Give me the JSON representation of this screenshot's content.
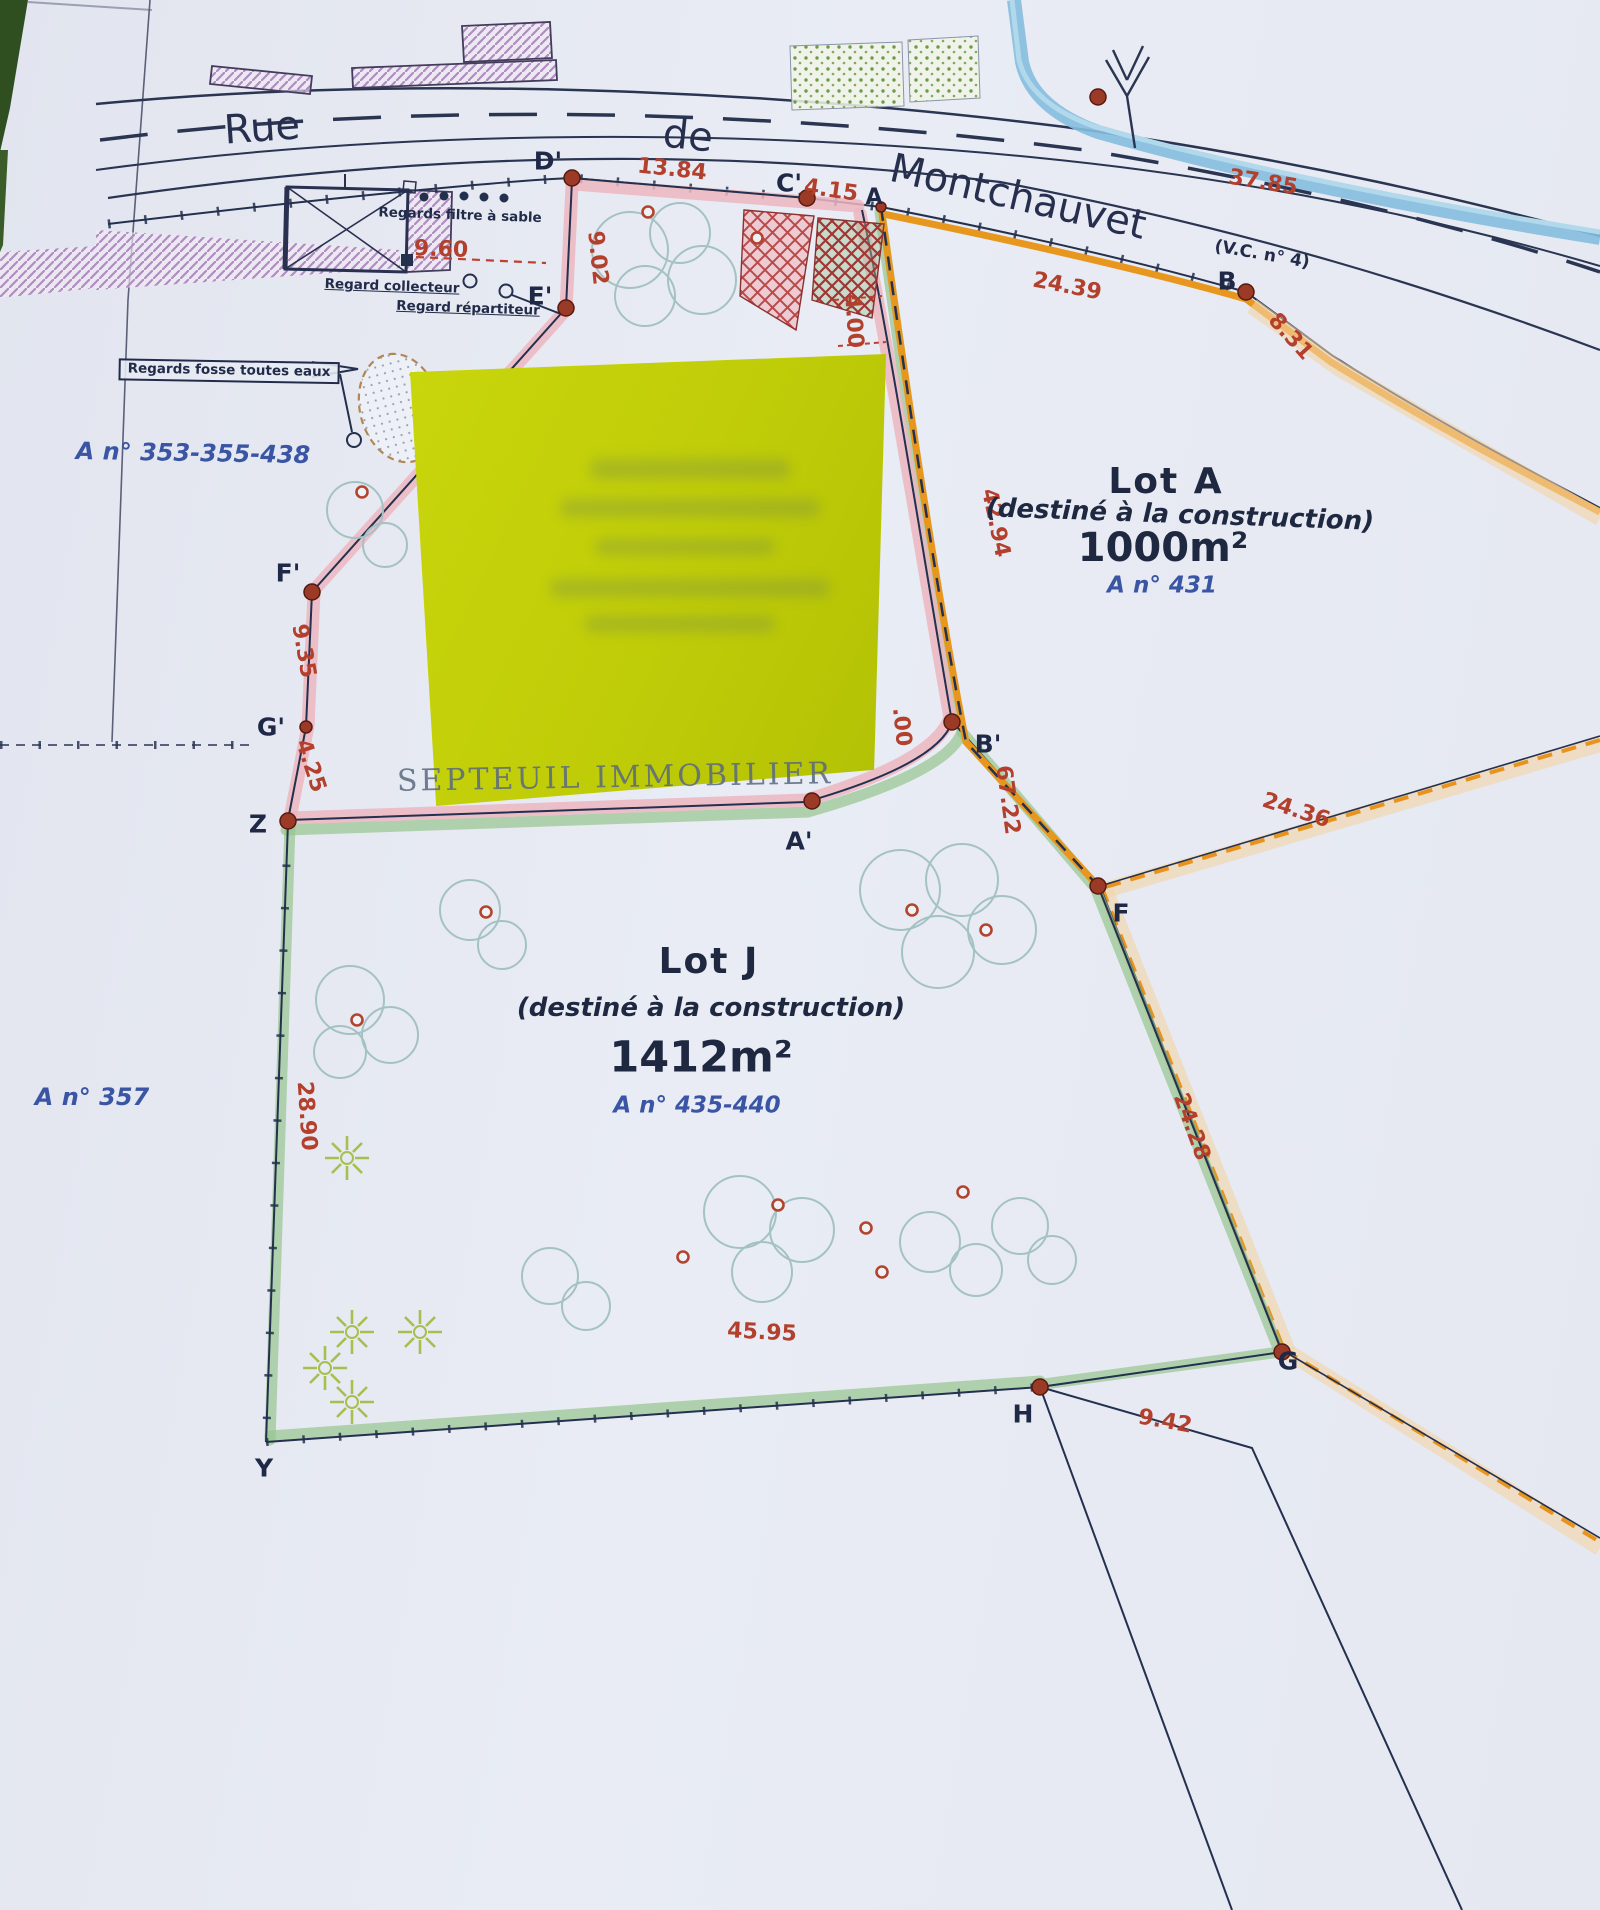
{
  "street": {
    "rue": "Rue",
    "de": "de",
    "montchauvet": "Montchauvet",
    "vc": "(V.C. n° 4)"
  },
  "watermark": "SEPTEUIL IMMOBILIER",
  "lot_a": {
    "title": "Lot A",
    "subtitle": "(destiné à la construction)",
    "area": "1000m²",
    "parcel_ref": "A n° 431"
  },
  "lot_j": {
    "title": "Lot J",
    "subtitle": "(destiné à la construction)",
    "area": "1412m²",
    "parcel_ref": "A n° 435-440"
  },
  "parcels": {
    "p353": "A n° 353-355-438",
    "p357": "A n° 357"
  },
  "legend": {
    "filtre": "Regards filtre à sable",
    "collecteur": "Regard collecteur",
    "repartiteur": "Regard répartiteur",
    "fosse": "Regards fosse toutes eaux"
  },
  "points": {
    "d2": "D'",
    "c2": "C'",
    "a": "A",
    "b": "B",
    "e2": "E'",
    "f2": "F'",
    "g2": "G'",
    "z": "Z",
    "y": "Y",
    "a2": "A'",
    "b2": "B'",
    "f": "F",
    "g": "G",
    "h": "H"
  },
  "measures": {
    "m1384": "13.84",
    "m415": "4.15",
    "m960": "9.60",
    "m902": "9.02",
    "m400": "4.00",
    "m2439": "24.39",
    "m831": "8.31",
    "m3785": "37.85",
    "m4294": "42.94",
    "m6722": "67.22",
    "m00": ".00",
    "m2436": "24.36",
    "m935": "9.35",
    "m425": "4.25",
    "m2890": "28.90",
    "m4595": "45.95",
    "m2428": "24.28",
    "m942": "9.42"
  },
  "colors": {
    "paper": "#e7eaf2",
    "note_yellow": "#bfcc08",
    "pink_band": "#ecb6c0",
    "green_band": "#96c494",
    "orange_band": "#e8971e",
    "cream_band": "#f4d4a6",
    "stream_blue": "#85bedf",
    "line_navy": "#23304e",
    "measure_red": "#b2402d",
    "parcel_blue": "#3a55a4",
    "photo_green": "#2f4f21"
  }
}
